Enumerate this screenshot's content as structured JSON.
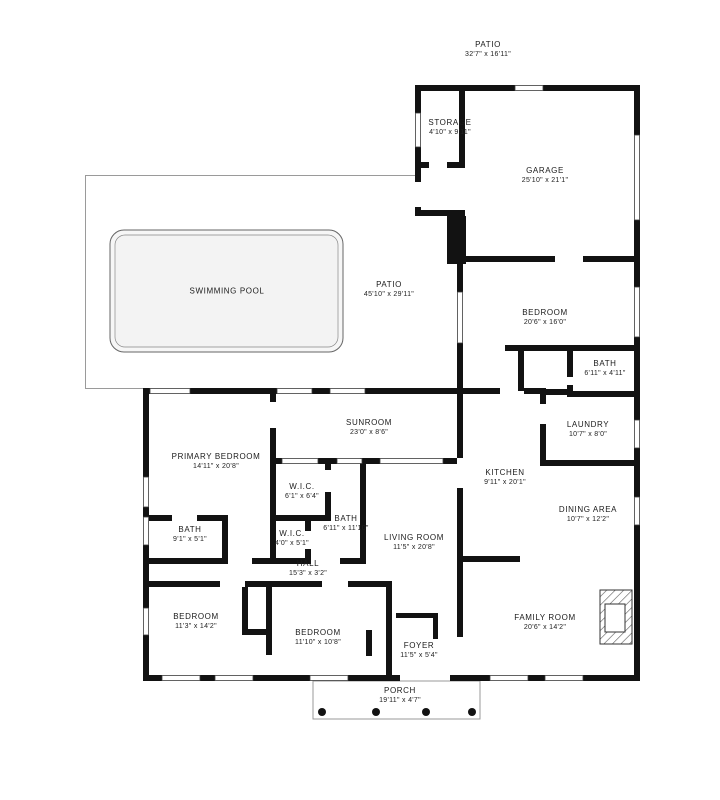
{
  "plan_title": "House Floor Plan",
  "pool": {
    "label": "SWIMMING POOL"
  },
  "rooms": [
    {
      "id": "patio-upper",
      "name": "PATIO",
      "dims": "32'7\" x 16'11\"",
      "x": 488,
      "y": 49
    },
    {
      "id": "storage",
      "name": "STORAGE",
      "dims": "4'10\" x 9'11\"",
      "x": 450,
      "y": 127
    },
    {
      "id": "garage",
      "name": "GARAGE",
      "dims": "25'10\" x 21'1\"",
      "x": 545,
      "y": 175
    },
    {
      "id": "swimming-pool",
      "name": "SWIMMING POOL",
      "dims": "",
      "x": 227,
      "y": 291
    },
    {
      "id": "patio-pool",
      "name": "PATIO",
      "dims": "45'10\" x 29'11\"",
      "x": 389,
      "y": 289
    },
    {
      "id": "bedroom-upper",
      "name": "BEDROOM",
      "dims": "20'6\" x 16'0\"",
      "x": 545,
      "y": 317
    },
    {
      "id": "bath-upper",
      "name": "BATH",
      "dims": "6'11\" x 4'11\"",
      "x": 605,
      "y": 368
    },
    {
      "id": "laundry",
      "name": "LAUNDRY",
      "dims": "10'7\" x 8'0\"",
      "x": 588,
      "y": 429
    },
    {
      "id": "sunroom",
      "name": "SUNROOM",
      "dims": "23'0\" x 8'6\"",
      "x": 369,
      "y": 427
    },
    {
      "id": "primary-bedroom",
      "name": "PRIMARY BEDROOM",
      "dims": "14'11\" x 20'8\"",
      "x": 216,
      "y": 461
    },
    {
      "id": "wic-1",
      "name": "W.I.C.",
      "dims": "6'1\" x 6'4\"",
      "x": 302,
      "y": 491
    },
    {
      "id": "kitchen",
      "name": "KITCHEN",
      "dims": "9'11\" x 20'1\"",
      "x": 505,
      "y": 477
    },
    {
      "id": "dining-area",
      "name": "DINING AREA",
      "dims": "10'7\" x 12'2\"",
      "x": 588,
      "y": 514
    },
    {
      "id": "bath-primary",
      "name": "BATH",
      "dims": "9'1\" x 5'1\"",
      "x": 190,
      "y": 534
    },
    {
      "id": "wic-2",
      "name": "W.I.C.",
      "dims": "4'0\" x 5'1\"",
      "x": 292,
      "y": 538
    },
    {
      "id": "bath-hall",
      "name": "BATH",
      "dims": "6'11\" x 11'10\"",
      "x": 346,
      "y": 523
    },
    {
      "id": "living-room",
      "name": "LIVING ROOM",
      "dims": "11'5\" x 20'8\"",
      "x": 414,
      "y": 542
    },
    {
      "id": "hall",
      "name": "HALL",
      "dims": "15'3\" x 3'2\"",
      "x": 308,
      "y": 568
    },
    {
      "id": "bedroom-left",
      "name": "BEDROOM",
      "dims": "11'3\" x 14'2\"",
      "x": 196,
      "y": 621
    },
    {
      "id": "bedroom-middle",
      "name": "BEDROOM",
      "dims": "11'10\" x 10'8\"",
      "x": 318,
      "y": 637
    },
    {
      "id": "family-room",
      "name": "FAMILY ROOM",
      "dims": "20'6\" x 14'2\"",
      "x": 545,
      "y": 622
    },
    {
      "id": "foyer",
      "name": "FOYER",
      "dims": "11'5\" x 5'4\"",
      "x": 419,
      "y": 650
    },
    {
      "id": "porch",
      "name": "PORCH",
      "dims": "19'11\" x 4'7\"",
      "x": 400,
      "y": 695
    }
  ],
  "colors": {
    "wall": "#121212",
    "window_stroke": "#3c3c3c",
    "patio_outline": "#9a9a9a",
    "pool_fill": "#f5f5f5",
    "text": "#1b1b1b"
  }
}
